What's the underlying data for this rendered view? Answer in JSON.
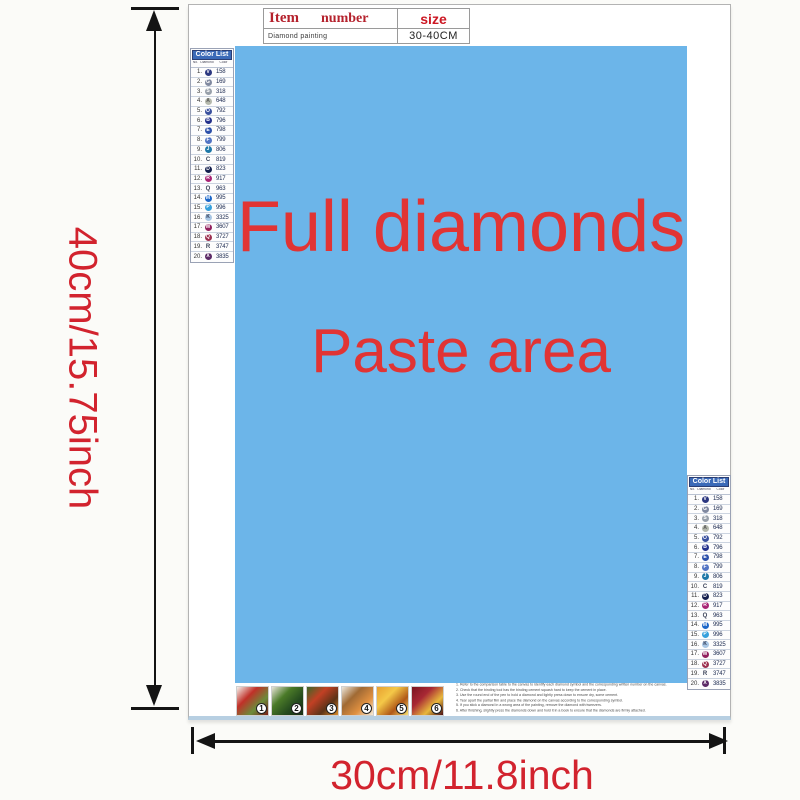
{
  "colors": {
    "paste_blue": "#6cb5e9",
    "accent_red": "#e13434",
    "dim_red": "#d2232e",
    "arrow_black": "#141414",
    "list_header_blue": "#3b6ab8"
  },
  "top_table": {
    "item_label": "Item",
    "number_label": "number",
    "size_label": "size",
    "row_name": "Diamond painting",
    "row_size": "30-40CM"
  },
  "paste_area": {
    "line1": "Full diamonds",
    "line2": "Paste area"
  },
  "dimensions": {
    "height_label": "40cm/15.75inch",
    "width_label": "30cm/11.8inch"
  },
  "color_list": {
    "title": "Color List",
    "col_no": "No.",
    "col_diamond": "Diamond",
    "col_color": "Color",
    "rows": [
      {
        "n": "1",
        "code": "158",
        "circle": "#2c3880",
        "glyph": "V",
        "glyph_color": "#ffffff"
      },
      {
        "n": "2",
        "code": "169",
        "circle": "#8089a0",
        "glyph": "G",
        "glyph_color": "#ffffff"
      },
      {
        "n": "3",
        "code": "318",
        "circle": "#98a0aa",
        "glyph": "S",
        "glyph_color": "#ffffff"
      },
      {
        "n": "4",
        "code": "648",
        "circle": "#b4b8ac",
        "glyph": "A",
        "glyph_color": "#555555"
      },
      {
        "n": "5",
        "code": "792",
        "circle": "#39509e",
        "glyph": "O",
        "glyph_color": "#ffffff"
      },
      {
        "n": "6",
        "code": "796",
        "circle": "#23318c",
        "glyph": "B",
        "glyph_color": "#ffffff"
      },
      {
        "n": "7",
        "code": "798",
        "circle": "#2c50aa",
        "glyph": "E",
        "glyph_color": "#ffffff"
      },
      {
        "n": "8",
        "code": "799",
        "circle": "#5274c4",
        "glyph": "F",
        "glyph_color": "#ffffff"
      },
      {
        "n": "9",
        "code": "806",
        "circle": "#1e78a8",
        "glyph": "J",
        "glyph_color": "#ffffff"
      },
      {
        "n": "10",
        "code": "819",
        "circle": null,
        "glyph": "C",
        "glyph_color": "#3a4258"
      },
      {
        "n": "11",
        "code": "823",
        "circle": "#141f4e",
        "glyph": "D",
        "glyph_color": "#ffffff"
      },
      {
        "n": "12",
        "code": "917",
        "circle": "#a82474",
        "glyph": "R",
        "glyph_color": "#ffffff"
      },
      {
        "n": "13",
        "code": "963",
        "circle": null,
        "glyph": "Q",
        "glyph_color": "#3a4258"
      },
      {
        "n": "14",
        "code": "995",
        "circle": "#1b66c8",
        "glyph": "M",
        "glyph_color": "#ffffff"
      },
      {
        "n": "15",
        "code": "996",
        "circle": "#36a0dc",
        "glyph": "P",
        "glyph_color": "#ffffff"
      },
      {
        "n": "16",
        "code": "3325",
        "circle": "#a8c6e4",
        "glyph": "K",
        "glyph_color": "#2c3550"
      },
      {
        "n": "17",
        "code": "3607",
        "circle": "#92205e",
        "glyph": "W",
        "glyph_color": "#ffffff"
      },
      {
        "n": "18",
        "code": "3727",
        "circle": "#9c3050",
        "glyph": "Q",
        "glyph_color": "#ffffff"
      },
      {
        "n": "19",
        "code": "3747",
        "circle": null,
        "glyph": "R",
        "glyph_color": "#3a4258"
      },
      {
        "n": "20",
        "code": "3835",
        "circle": "#5c2a66",
        "glyph": "X",
        "glyph_color": "#ffffff"
      }
    ]
  },
  "steps": {
    "tiles": [
      {
        "num": "1",
        "palette": [
          "#f5f2ec",
          "#c03028",
          "#6b8c3a",
          "#7a1e18"
        ]
      },
      {
        "num": "2",
        "palette": [
          "#e8e4d8",
          "#4a7a28",
          "#244a1e",
          "#1a2e14"
        ]
      },
      {
        "num": "3",
        "palette": [
          "#3a6828",
          "#c24024",
          "#5c3318",
          "#d88a28"
        ]
      },
      {
        "num": "4",
        "palette": [
          "#ece6da",
          "#a06a34",
          "#e09040",
          "#f4ead8"
        ]
      },
      {
        "num": "5",
        "palette": [
          "#e8a030",
          "#f4c848",
          "#b05818",
          "#f8e070"
        ]
      },
      {
        "num": "6",
        "palette": [
          "#7a1420",
          "#a82834",
          "#e8b83c",
          "#4a0e14"
        ]
      }
    ]
  },
  "instructions": {
    "lines": [
      "Refer to the comparison table to the canvas to identify each diamond symbol and the corresponding written number on the canvas.",
      "Check that the binding tool has the binding cement squash hard to keep the cement in place.",
      "Use the round end of the pen to hold a diamond and lightly press down to ensure dry, some cement.",
      "Tear apart the partial film and place the diamond on the canvas according to the corresponding symbol.",
      "If you stick a diamond in a wrong area of the painting, remove the diamond with tweezers.",
      "After finishing, slightly press the diamonds down and hold it in a book to ensure that the diamonds are firmly attached."
    ]
  }
}
